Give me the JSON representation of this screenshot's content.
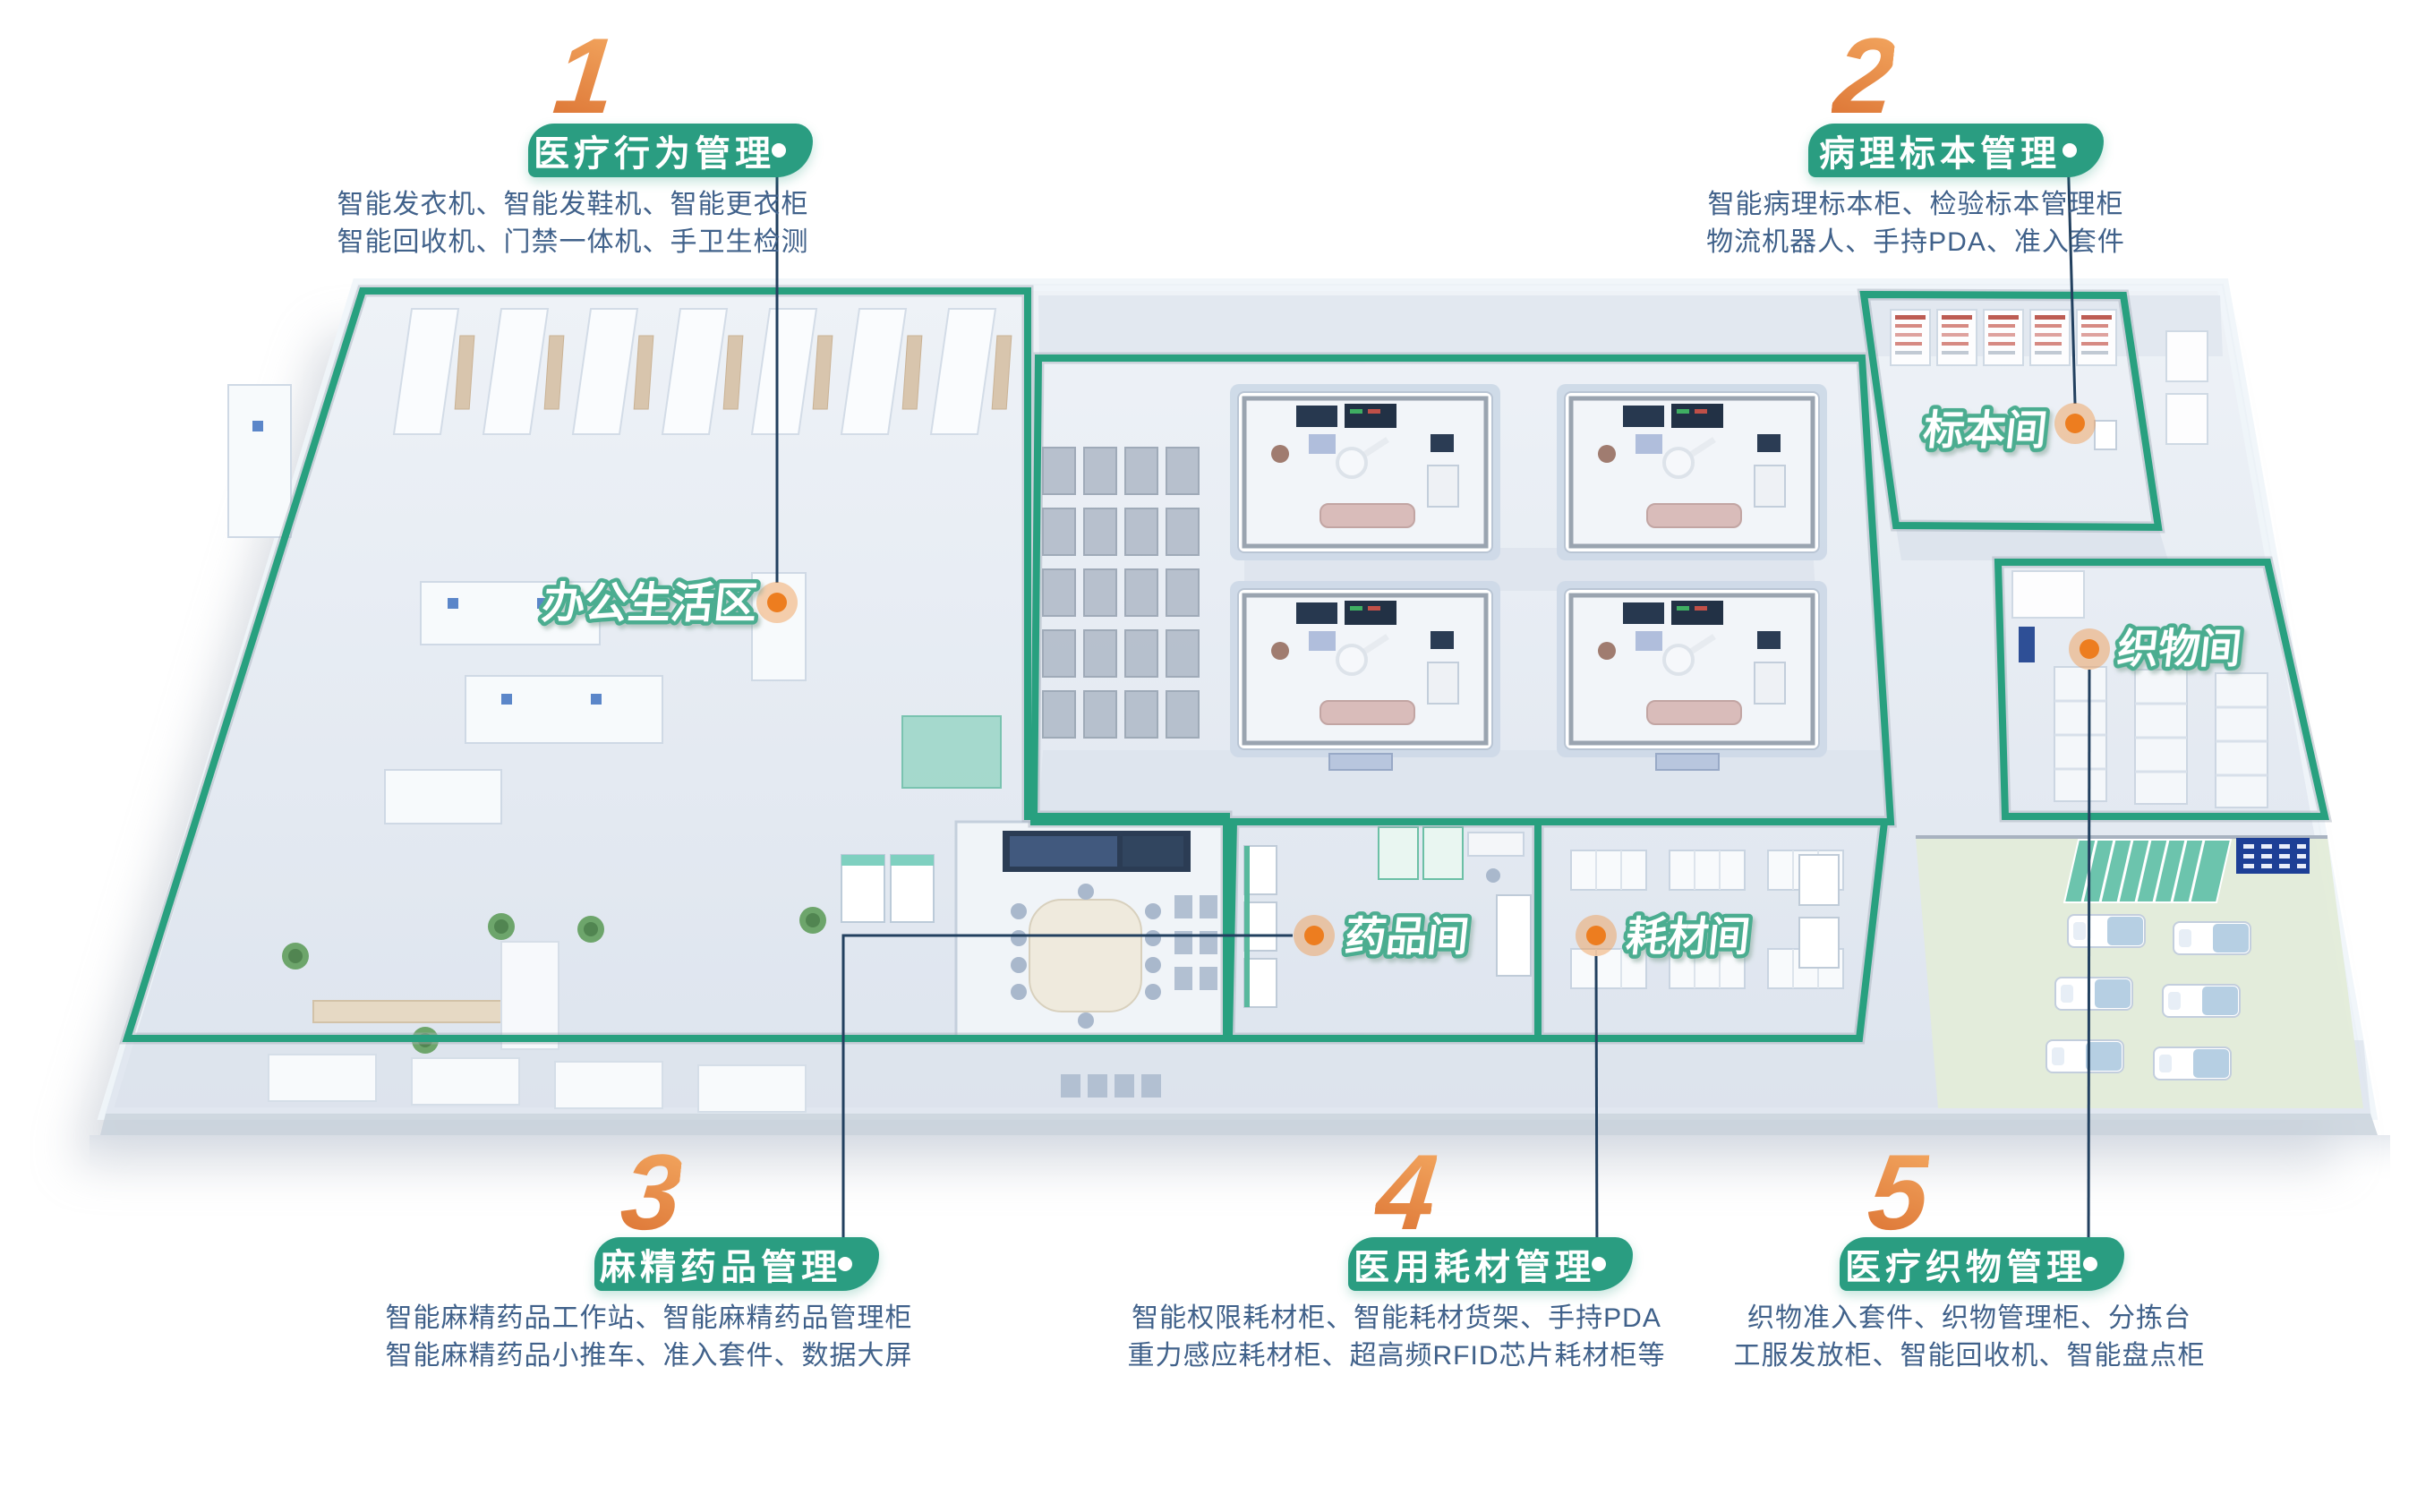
{
  "colors": {
    "pill_green": "#2A9D81",
    "zone_green": "#28A07F",
    "label_stroke_green": "#4BAD90",
    "number_orange": "#E8873F",
    "dot_orange": "#ED7D1F",
    "desc_text": "#40618A",
    "leader_line": "#22405F"
  },
  "sections": [
    {
      "number": "1",
      "title": "医疗行为管理",
      "desc_line1": "智能发衣机、智能发鞋机、智能更衣柜",
      "desc_line2": "智能回收机、门禁一体机、手卫生检测"
    },
    {
      "number": "2",
      "title": "病理标本管理",
      "desc_line1": "智能病理标本柜、检验标本管理柜",
      "desc_line2": "物流机器人、手持PDA、准入套件"
    },
    {
      "number": "3",
      "title": "麻精药品管理",
      "desc_line1": "智能麻精药品工作站、智能麻精药品管理柜",
      "desc_line2": "智能麻精药品小推车、准入套件、数据大屏"
    },
    {
      "number": "4",
      "title": "医用耗材管理",
      "desc_line1": "智能权限耗材柜、智能耗材货架、手持PDA",
      "desc_line2": "重力感应耗材柜、超高频RFID芯片耗材柜等"
    },
    {
      "number": "5",
      "title": "医疗织物管理",
      "desc_line1": "织物准入套件、织物管理柜、分拣台",
      "desc_line2": "工服发放柜、智能回收机、智能盘点柜"
    }
  ],
  "map": {
    "rooms": [
      {
        "label": "办公生活区"
      },
      {
        "label": "标本间"
      },
      {
        "label": "织物间"
      },
      {
        "label": "药品间"
      },
      {
        "label": "耗材间"
      }
    ]
  }
}
